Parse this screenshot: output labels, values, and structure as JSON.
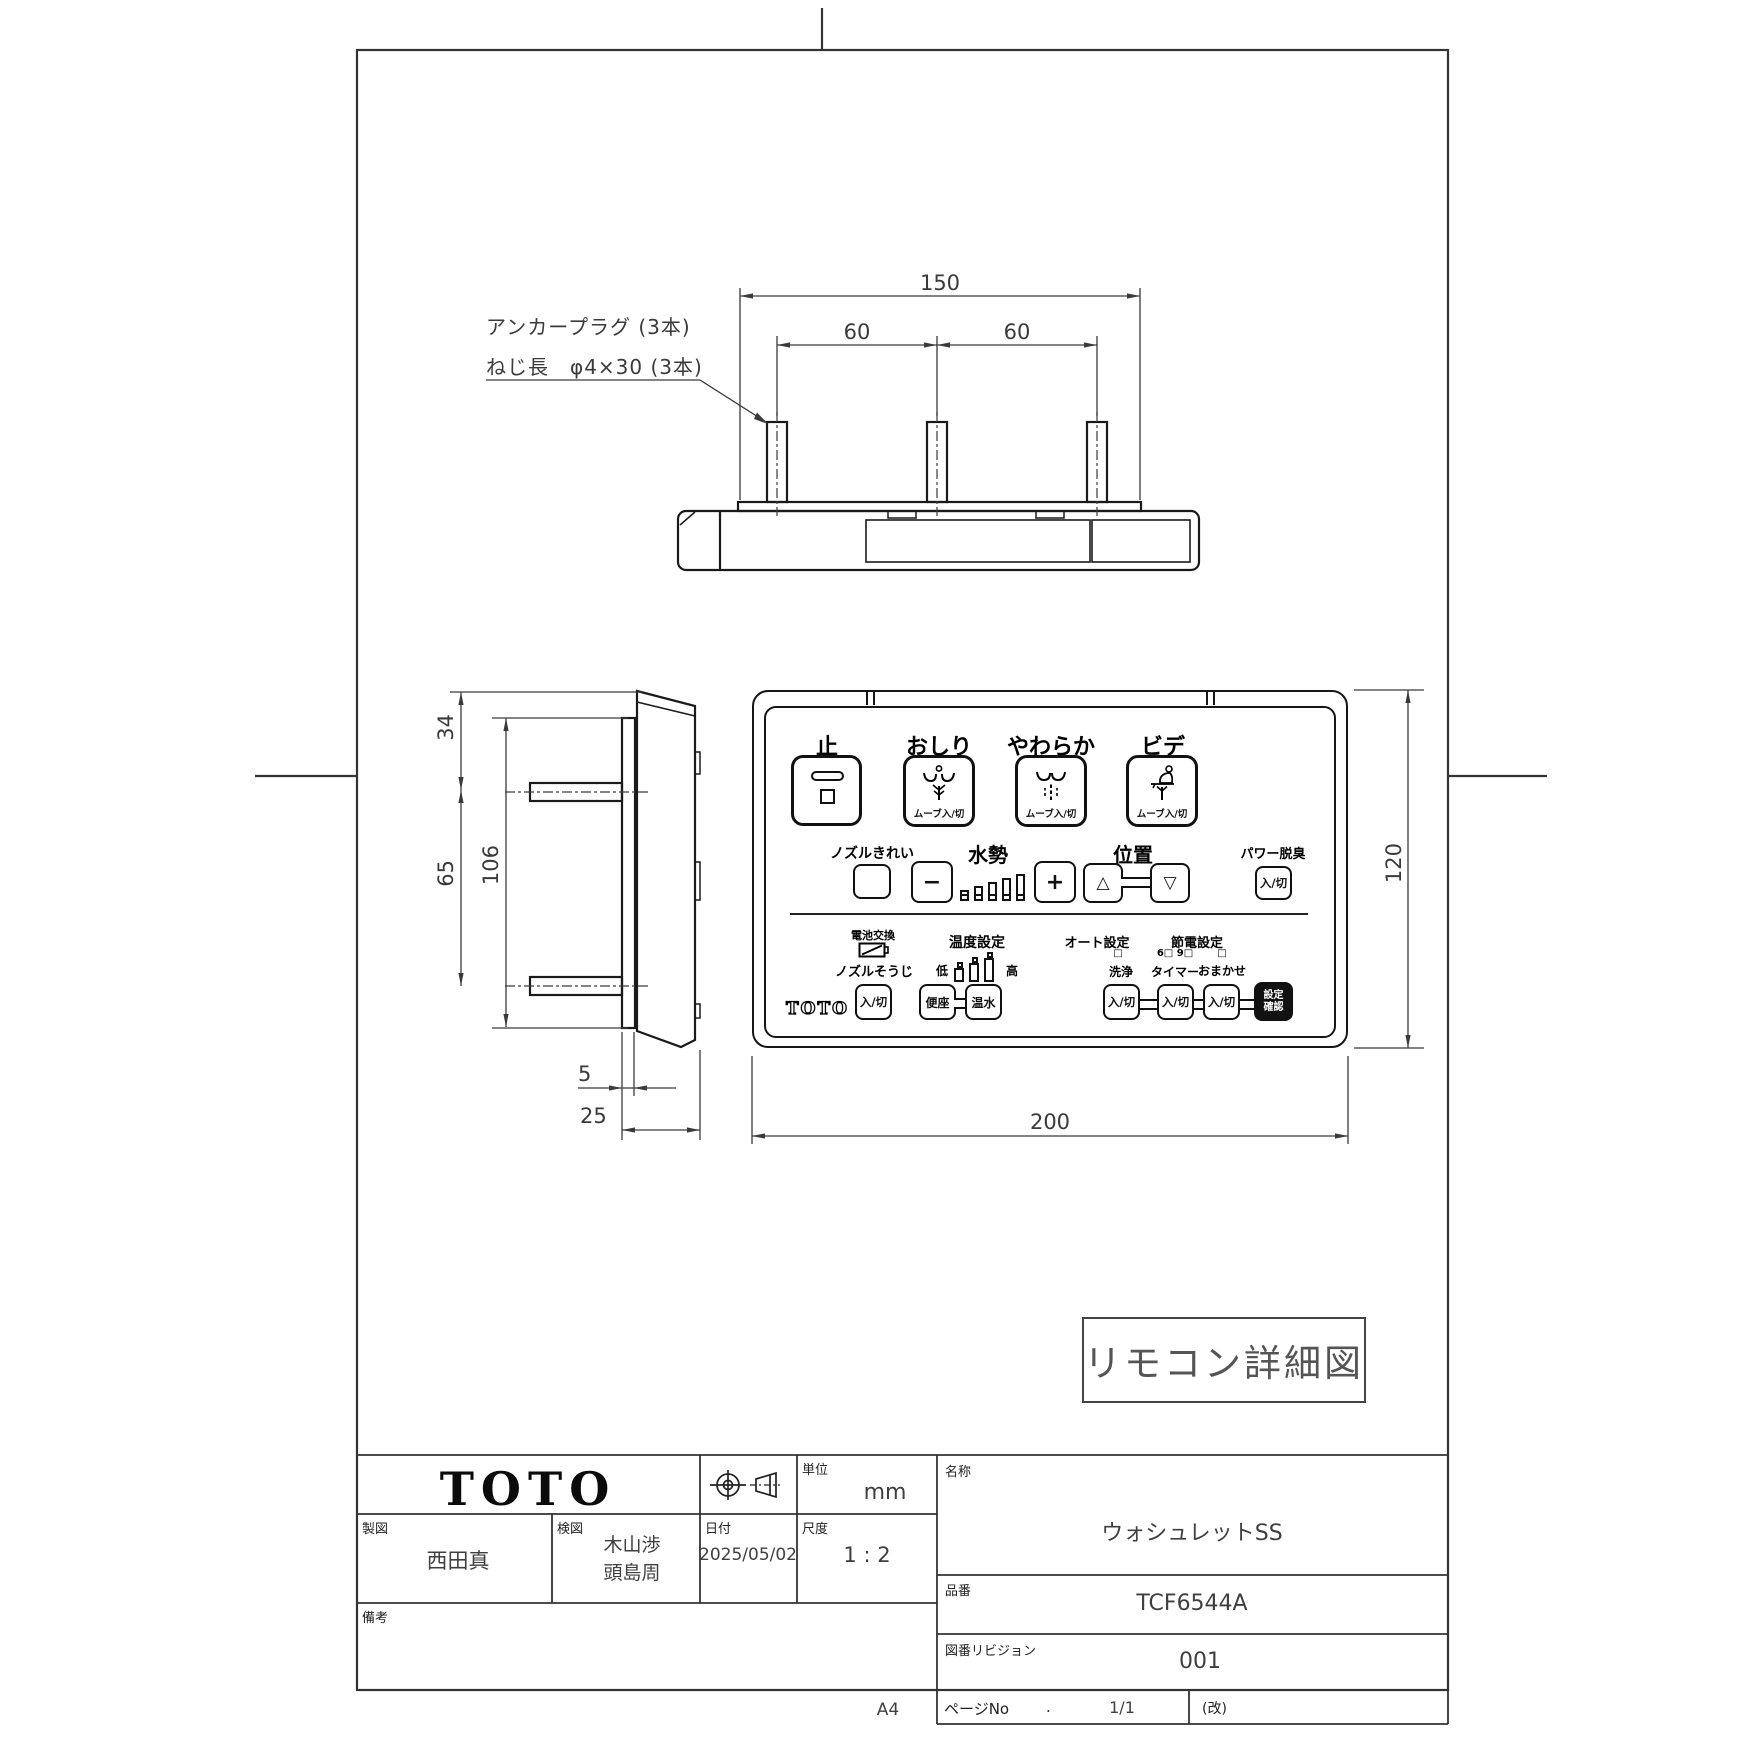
{
  "annotation": {
    "line1": "アンカープラグ (3本)",
    "line2": "ねじ長　φ4×30 (3本)"
  },
  "dims": {
    "top_overall": "150",
    "pitch_left": "60",
    "pitch_right": "60",
    "side_top": "34",
    "side_bottom": "65",
    "side_inner": "106",
    "plate_thickness": "5",
    "depth": "25",
    "front_width": "200",
    "front_height": "120"
  },
  "detail_label": "リモコン詳細図",
  "remote": {
    "brand": "TOTO",
    "stop_label": "止",
    "oshiri_label": "おしり",
    "soft_label": "やわらか",
    "bidet_label": "ビデ",
    "move_onoff": "ムーブ入/切",
    "nozzle_clean_label": "ノズルきれい",
    "water_label": "水勢",
    "minus": "−",
    "plus": "+",
    "water_levels": 5,
    "position_label": "位置",
    "up": "△",
    "down": "▽",
    "deodorizer_label": "パワー脱臭",
    "onoff": "入/切",
    "battery_label": "電池交換",
    "nozzle_clean2_label": "ノズルそうじ",
    "temp_label": "温度設定",
    "low": "低",
    "high": "高",
    "temp_levels": 3,
    "seat_label": "便座",
    "warm_label": "温水",
    "auto_label": "オート設定",
    "auto_ind": "□",
    "wash_label": "洗浄",
    "eco_label": "節電設定",
    "eco_ind_69": "6□ 9□",
    "eco_ind": "□",
    "timer_label": "タイマー",
    "omakase_label": "おまかせ",
    "confirm_line1": "設定",
    "confirm_line2": "確認"
  },
  "title_block": {
    "brand": "TOTO",
    "unit_label": "単位",
    "unit_value": "mm",
    "drafter_label": "製図",
    "drafter_value": "西田真",
    "checker_label": "検図",
    "checker_value_1": "木山渉",
    "checker_value_2": "頭島周",
    "date_label": "日付",
    "date_value": "2025/05/02",
    "scale_label": "尺度",
    "scale_value": "1 : 2",
    "remarks_label": "備考",
    "name_label": "名称",
    "name_value": "ウォシュレットSS",
    "part_label": "品番",
    "part_value": "TCF6544A",
    "rev_label": "図番リビジョン",
    "rev_value": "001",
    "page_label": "ページNo",
    "page_dot": ".",
    "page_value": "1/1",
    "kai_mark": "(改)",
    "paper_size": "A4"
  }
}
